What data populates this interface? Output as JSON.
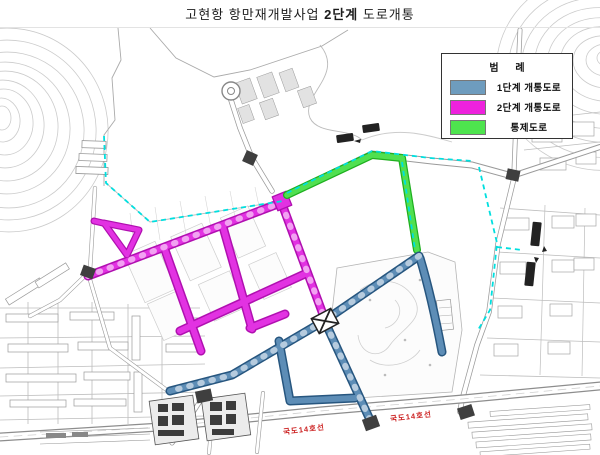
{
  "title": {
    "prefix": "고현항 항만재개발사업 ",
    "bold": "2단계",
    "suffix": " 도로개통"
  },
  "legend": {
    "title": "범 례",
    "items": [
      {
        "label": "1단계 개통도로",
        "color": "#6e9cbe"
      },
      {
        "label": "2단계 개통도로",
        "color": "#ee22dd"
      },
      {
        "label": "통제도로",
        "color": "#4ee44e"
      }
    ]
  },
  "map": {
    "road_labels": [
      {
        "text": "국도14호선"
      },
      {
        "text": "국도14호선"
      }
    ],
    "colors": {
      "phase1_road": "#5d8db6",
      "phase2_road": "#e232e2",
      "control_road": "#50e050",
      "coastline": "#00dfdf",
      "road_label": "#cc2222"
    }
  }
}
